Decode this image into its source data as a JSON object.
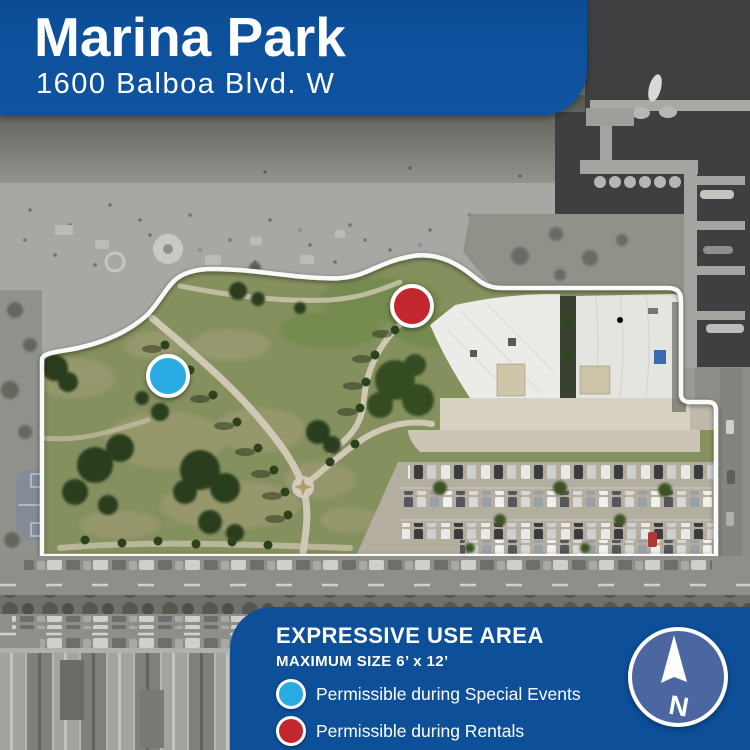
{
  "banner": {
    "title": "Marina Park",
    "subtitle": "1600 Balboa Blvd. W"
  },
  "legend": {
    "title": "EXPRESSIVE USE AREA",
    "subtitle": "MAXIMUM SIZE 6’ x 12’",
    "items": [
      {
        "label": "Permissible during Special Events",
        "color": "#29abe2"
      },
      {
        "label": "Permissible during Rentals",
        "color": "#c1272d"
      }
    ]
  },
  "compass": {
    "label": "N"
  },
  "map": {
    "description": "Aerial photo of Marina Park with white park boundary outline",
    "panel_color": "#0d509b",
    "compass_color": "#4c66a2",
    "boundary_color": "#ffffff",
    "markers": [
      {
        "name": "special-events-marker",
        "color": "#29abe2"
      },
      {
        "name": "rentals-marker",
        "color": "#c1272d"
      }
    ]
  }
}
